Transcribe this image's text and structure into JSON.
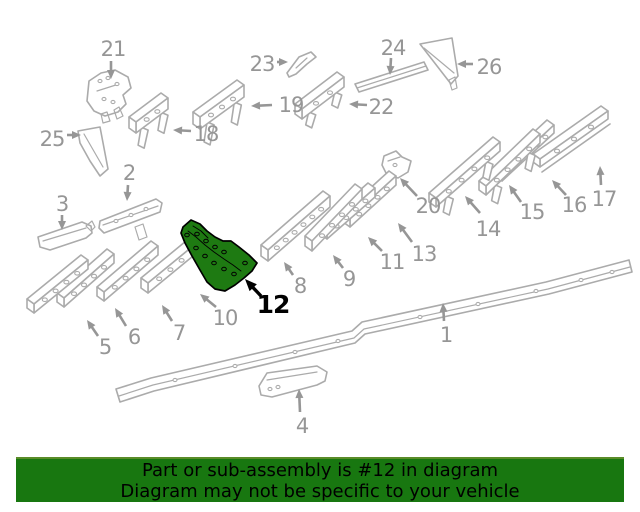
{
  "diagram": {
    "type": "exploded-parts-diagram",
    "highlighted_part": "12",
    "colors": {
      "line": "#ababab",
      "label": "#969696",
      "highlight_fill": "#1e7a12",
      "highlight_stroke": "#000000",
      "highlight_label": "#000000"
    },
    "callouts": [
      {
        "num": "1",
        "lx": 446,
        "ly": 342,
        "ax": 444,
        "ay": 321,
        "tx": 443,
        "ty": 303
      },
      {
        "num": "2",
        "lx": 129,
        "ly": 180,
        "ax": 128,
        "ay": 185,
        "tx": 127,
        "ty": 201
      },
      {
        "num": "3",
        "lx": 62,
        "ly": 211,
        "ax": 62,
        "ay": 215,
        "tx": 62,
        "ty": 230
      },
      {
        "num": "4",
        "lx": 302,
        "ly": 433,
        "ax": 300,
        "ay": 412,
        "tx": 299,
        "ty": 389
      },
      {
        "num": "5",
        "lx": 105,
        "ly": 354,
        "ax": 98,
        "ay": 336,
        "tx": 87,
        "ty": 320
      },
      {
        "num": "6",
        "lx": 134,
        "ly": 344,
        "ax": 126,
        "ay": 326,
        "tx": 115,
        "ty": 308
      },
      {
        "num": "7",
        "lx": 179,
        "ly": 340,
        "ax": 172,
        "ay": 321,
        "tx": 162,
        "ty": 305
      },
      {
        "num": "8",
        "lx": 300,
        "ly": 293,
        "ax": 293,
        "ay": 275,
        "tx": 284,
        "ty": 262
      },
      {
        "num": "9",
        "lx": 349,
        "ly": 286,
        "ax": 343,
        "ay": 268,
        "tx": 333,
        "ty": 255
      },
      {
        "num": "10",
        "lx": 225,
        "ly": 325,
        "ax": 216,
        "ay": 307,
        "tx": 200,
        "ty": 294
      },
      {
        "num": "11",
        "lx": 392,
        "ly": 269,
        "ax": 382,
        "ay": 251,
        "tx": 368,
        "ty": 237
      },
      {
        "num": "12",
        "lx": 273,
        "ly": 313,
        "ax": 261,
        "ay": 296,
        "tx": 245,
        "ty": 279
      },
      {
        "num": "13",
        "lx": 424,
        "ly": 261,
        "ax": 412,
        "ay": 242,
        "tx": 398,
        "ty": 223
      },
      {
        "num": "14",
        "lx": 488,
        "ly": 236,
        "ax": 480,
        "ay": 213,
        "tx": 465,
        "ty": 196
      },
      {
        "num": "15",
        "lx": 532,
        "ly": 219,
        "ax": 521,
        "ay": 202,
        "tx": 509,
        "ty": 185
      },
      {
        "num": "16",
        "lx": 574,
        "ly": 212,
        "ax": 566,
        "ay": 195,
        "tx": 552,
        "ty": 180
      },
      {
        "num": "17",
        "lx": 604,
        "ly": 206,
        "ax": 601,
        "ay": 185,
        "tx": 600,
        "ty": 166
      },
      {
        "num": "18",
        "lx": 206,
        "ly": 141,
        "ax": 191,
        "ay": 131,
        "tx": 173,
        "ty": 130
      },
      {
        "num": "19",
        "lx": 291,
        "ly": 112,
        "ax": 272,
        "ay": 105,
        "tx": 251,
        "ty": 106
      },
      {
        "num": "20",
        "lx": 428,
        "ly": 213,
        "ax": 417,
        "ay": 196,
        "tx": 400,
        "ty": 178
      },
      {
        "num": "21",
        "lx": 113,
        "ly": 56,
        "ax": 111,
        "ay": 61,
        "tx": 111,
        "ty": 79
      },
      {
        "num": "22",
        "lx": 381,
        "ly": 114,
        "ax": 367,
        "ay": 105,
        "tx": 349,
        "ty": 104
      },
      {
        "num": "23",
        "lx": 262,
        "ly": 71,
        "ax": 277,
        "ay": 62,
        "tx": 288,
        "ty": 62
      },
      {
        "num": "24",
        "lx": 393,
        "ly": 55,
        "ax": 391,
        "ay": 58,
        "tx": 390,
        "ty": 75
      },
      {
        "num": "25",
        "lx": 52,
        "ly": 146,
        "ax": 67,
        "ay": 135,
        "tx": 81,
        "ty": 135
      },
      {
        "num": "26",
        "lx": 489,
        "ly": 74,
        "ax": 473,
        "ay": 64,
        "tx": 457,
        "ty": 64
      }
    ]
  },
  "banner": {
    "bg": "#187710",
    "accent": "#5a8c28",
    "text_color": "#000000",
    "line1": "Part or sub-assembly is #12 in diagram",
    "line2": "Diagram may not be specific to your vehicle"
  }
}
